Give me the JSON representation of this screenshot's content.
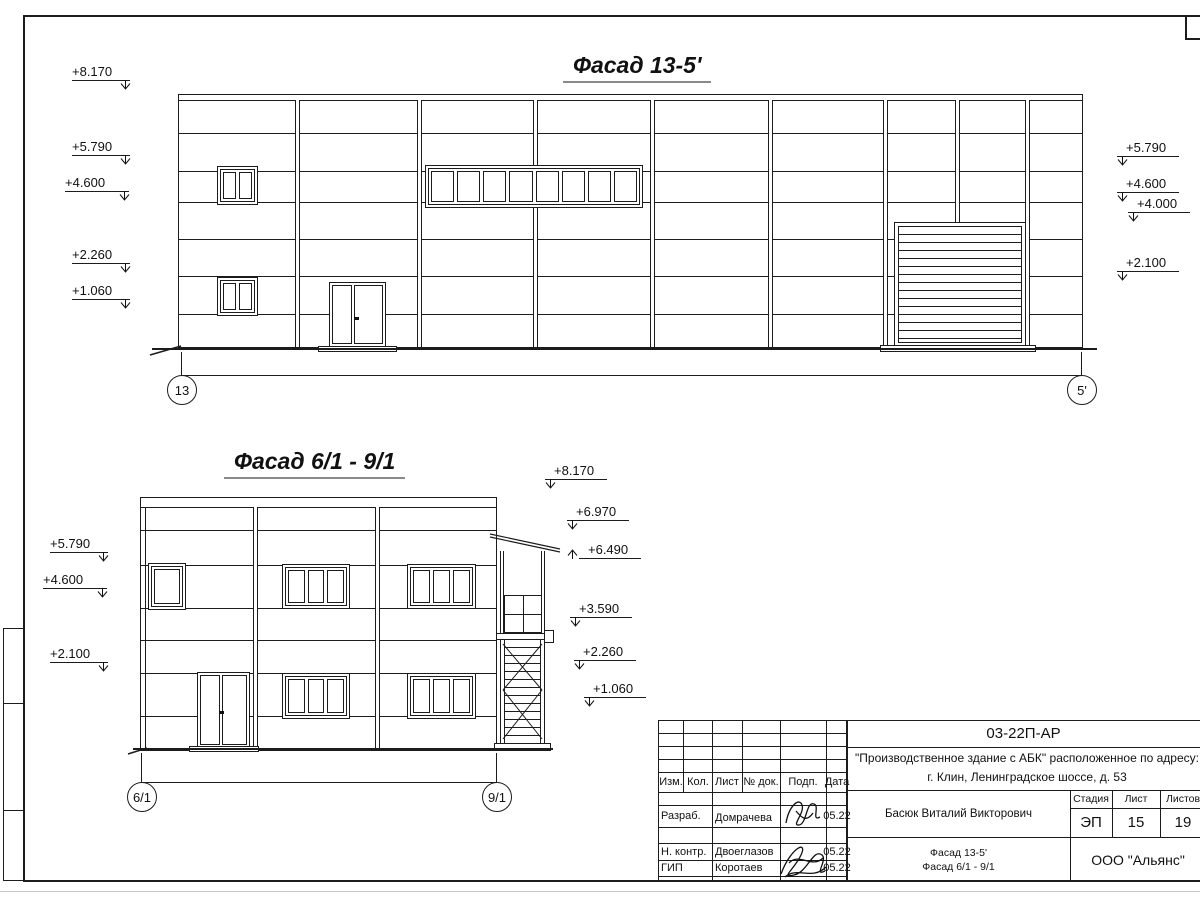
{
  "sheet": {
    "facade1": {
      "title": "Фасад 13-5'",
      "marks_left": [
        "+8.170",
        "+5.790",
        "+4.600",
        "+2.260",
        "+1.060"
      ],
      "marks_right": [
        "+5.790",
        "+4.600",
        "+4.000",
        "+2.100"
      ],
      "axis_left": "13",
      "axis_right": "5'"
    },
    "facade2": {
      "title": "Фасад 6/1 - 9/1",
      "marks_left": [
        "+5.790",
        "+4.600",
        "+2.100"
      ],
      "marks_right": [
        "+8.170",
        "+6.970",
        "+6.490",
        "+3.590",
        "+2.260",
        "+1.060"
      ],
      "axis_left": "6/1",
      "axis_right": "9/1"
    },
    "titleblock": {
      "code": "03-22П-АР",
      "project_line1": "\"Производственное здание с АБК\" расположенное по адресу:",
      "project_line2": "г. Клин, Ленинградское шоссе, д. 53",
      "author": "Басюк Виталий Викторович",
      "stage_label": "Стадия",
      "stage_value": "ЭП",
      "sheet_label": "Лист",
      "sheet_value": "15",
      "sheets_label": "Листов",
      "sheets_value": "19",
      "content_line1": "Фасад 13-5'",
      "content_line2": "Фасад 6/1 - 9/1",
      "organization": "ООО \"Альянс\"",
      "columns": [
        "Изм.",
        "Кол.",
        "Лист",
        "№ док.",
        "Подп.",
        "Дата"
      ],
      "rows": [
        {
          "role": "Разраб.",
          "name": "Домрачева",
          "date": "05.22"
        },
        {
          "role": "Н. контр.",
          "name": "Двоеглазов",
          "date": "05.22"
        },
        {
          "role": "ГИП",
          "name": "Коротаев",
          "date": "05.22"
        }
      ]
    }
  }
}
